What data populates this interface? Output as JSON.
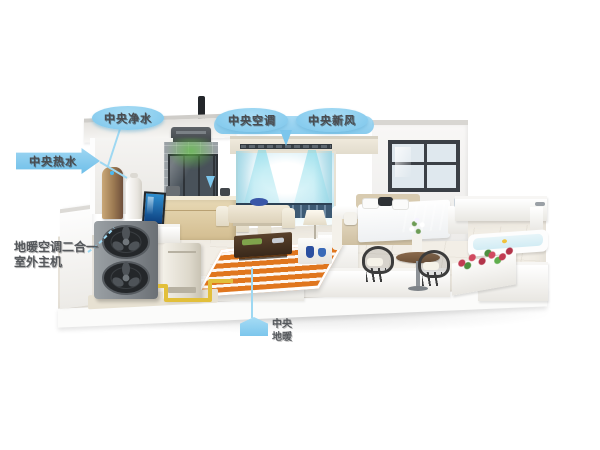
{
  "diagram": {
    "labels": {
      "water_purifier": "中央净水",
      "central_ac": "中央空调",
      "fresh_air": "中央新风",
      "hot_water": "中央热水",
      "heat_pump_line1": "地暖空调二合一",
      "heat_pump_line2": "室外主机",
      "floor_heating_line1": "中央",
      "floor_heating_line2": "地暖"
    },
    "colors": {
      "callout_blue": "#7cc6ec",
      "label_text": "#4a4d51",
      "pipe_yellow": "#e2bf3a",
      "rug_orange": "#e0761e",
      "airflow_cyan": "#74d6e6",
      "heat_pump_gray": "#82878c",
      "bedding_blue": "#8fb3e8",
      "flower_red": "#c23b52",
      "plant_green": "#5fae4d"
    }
  }
}
